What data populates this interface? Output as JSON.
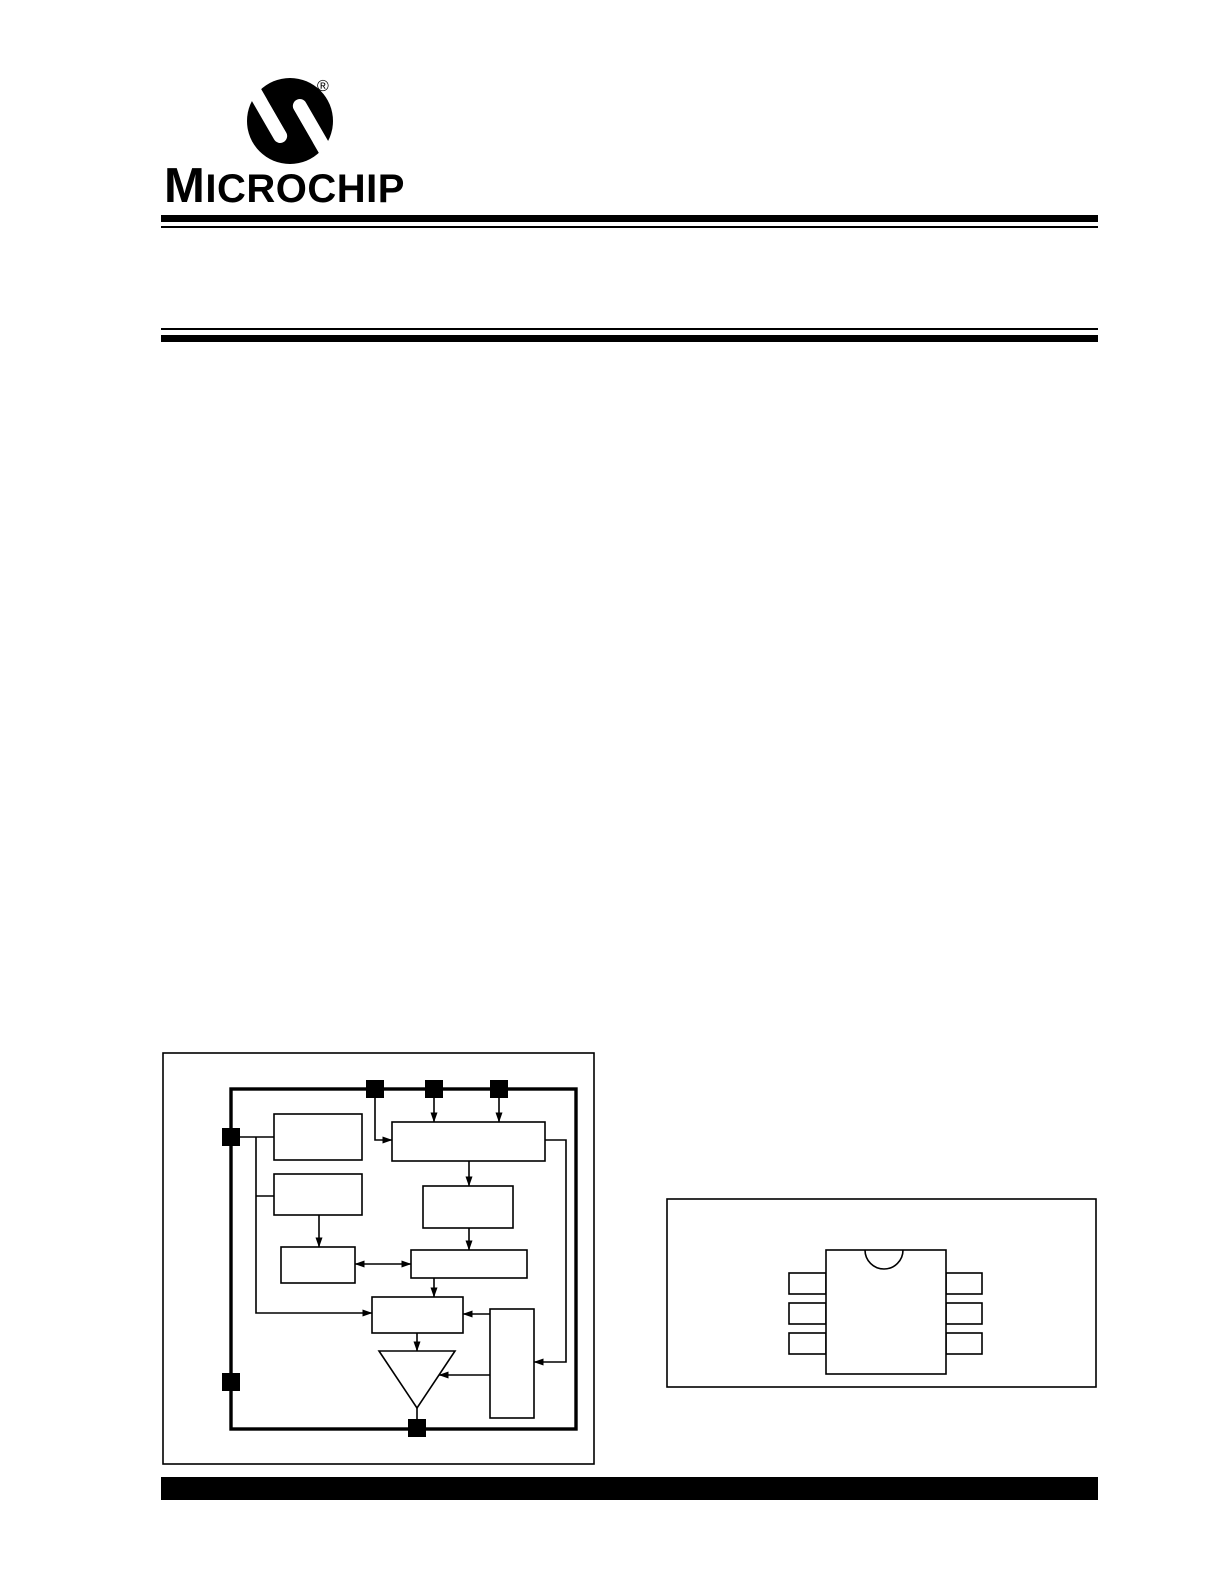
{
  "brand": {
    "wordmark_initial": "M",
    "wordmark_rest": "ICROCHIP",
    "registered_mark": "®"
  },
  "colors": {
    "ink": "#000000",
    "paper": "#ffffff"
  },
  "figures": {
    "block_diagram": {
      "frame": {
        "x": 163,
        "y": 1053,
        "w": 431,
        "h": 411
      },
      "chip_border": {
        "x": 231,
        "y": 1089,
        "w": 345,
        "h": 340
      },
      "boxes": [
        {
          "name": "block-top-left",
          "x": 274,
          "y": 1114,
          "w": 88,
          "h": 46
        },
        {
          "name": "block-mid-left",
          "x": 274,
          "y": 1174,
          "w": 88,
          "h": 41
        },
        {
          "name": "block-small-left",
          "x": 281,
          "y": 1247,
          "w": 74,
          "h": 36
        },
        {
          "name": "block-wide-top",
          "x": 392,
          "y": 1122,
          "w": 153,
          "h": 39
        },
        {
          "name": "block-mid-right",
          "x": 423,
          "y": 1186,
          "w": 90,
          "h": 42
        },
        {
          "name": "block-wide-middle",
          "x": 411,
          "y": 1250,
          "w": 116,
          "h": 28
        },
        {
          "name": "block-center-lower",
          "x": 372,
          "y": 1297,
          "w": 91,
          "h": 36
        },
        {
          "name": "block-tall-right",
          "x": 490,
          "y": 1309,
          "w": 44,
          "h": 109
        }
      ],
      "triangle": {
        "name": "triangle-buffer",
        "points": "379,1351 455,1351 417,1408"
      },
      "connectors": [
        {
          "name": "connector-line",
          "arrows": "end",
          "points": [
            [
              375,
              1098
            ],
            [
              375,
              1140
            ],
            [
              392,
              1140
            ]
          ]
        },
        {
          "name": "connector-line",
          "arrows": "end",
          "points": [
            [
              434,
              1098
            ],
            [
              434,
              1122
            ]
          ]
        },
        {
          "name": "connector-line",
          "arrows": "end",
          "points": [
            [
              499,
              1098
            ],
            [
              499,
              1122
            ]
          ]
        },
        {
          "name": "connector-line",
          "arrows": "none",
          "points": [
            [
              240,
              1137
            ],
            [
              274,
              1137
            ]
          ]
        },
        {
          "name": "connector-line",
          "arrows": "end",
          "points": [
            [
              256,
              1137
            ],
            [
              256,
              1313
            ],
            [
              372,
              1313
            ]
          ]
        },
        {
          "name": "connector-line",
          "arrows": "none",
          "points": [
            [
              256,
              1196
            ],
            [
              274,
              1196
            ]
          ]
        },
        {
          "name": "connector-line",
          "arrows": "end",
          "points": [
            [
              319,
              1215
            ],
            [
              319,
              1247
            ]
          ]
        },
        {
          "name": "connector-line",
          "arrows": "both",
          "points": [
            [
              355,
              1264
            ],
            [
              411,
              1264
            ]
          ]
        },
        {
          "name": "connector-line",
          "arrows": "end",
          "points": [
            [
              469,
              1161
            ],
            [
              469,
              1186
            ]
          ]
        },
        {
          "name": "connector-line",
          "arrows": "end",
          "points": [
            [
              469,
              1228
            ],
            [
              469,
              1250
            ]
          ]
        },
        {
          "name": "connector-line",
          "arrows": "end",
          "points": [
            [
              434,
              1278
            ],
            [
              434,
              1297
            ]
          ]
        },
        {
          "name": "connector-line",
          "arrows": "end",
          "points": [
            [
              490,
              1314
            ],
            [
              463,
              1314
            ]
          ]
        },
        {
          "name": "connector-line",
          "arrows": "end",
          "points": [
            [
              417,
              1333
            ],
            [
              417,
              1351
            ]
          ]
        },
        {
          "name": "connector-line",
          "arrows": "end",
          "points": [
            [
              490,
              1375
            ],
            [
              439,
              1375
            ]
          ]
        },
        {
          "name": "connector-line",
          "arrows": "end",
          "points": [
            [
              545,
              1140
            ],
            [
              566,
              1140
            ],
            [
              566,
              1362
            ],
            [
              534,
              1362
            ]
          ]
        },
        {
          "name": "connector-line",
          "arrows": "none",
          "points": [
            [
              417,
              1408
            ],
            [
              417,
              1420
            ]
          ]
        }
      ],
      "pads": [
        {
          "name": "pin-pad-top-1",
          "x": 366,
          "y": 1080,
          "w": 18,
          "h": 18
        },
        {
          "name": "pin-pad-top-2",
          "x": 425,
          "y": 1080,
          "w": 18,
          "h": 18
        },
        {
          "name": "pin-pad-top-3",
          "x": 490,
          "y": 1080,
          "w": 18,
          "h": 18
        },
        {
          "name": "pin-pad-left-1",
          "x": 222,
          "y": 1128,
          "w": 18,
          "h": 18
        },
        {
          "name": "pin-pad-left-2",
          "x": 222,
          "y": 1373,
          "w": 18,
          "h": 18
        },
        {
          "name": "pin-pad-bottom",
          "x": 408,
          "y": 1419,
          "w": 18,
          "h": 18
        }
      ]
    },
    "package_outline": {
      "frame": {
        "x": 667,
        "y": 1199,
        "w": 429,
        "h": 188
      },
      "body": {
        "x": 826,
        "y": 1250,
        "w": 120,
        "h": 124
      },
      "notch": {
        "cx": 884,
        "cy": 1250,
        "r": 19
      },
      "leads_left": [
        {
          "name": "package-lead-left-1",
          "x": 789,
          "y": 1273,
          "w": 37,
          "h": 21
        },
        {
          "name": "package-lead-left-2",
          "x": 789,
          "y": 1303,
          "w": 37,
          "h": 21
        },
        {
          "name": "package-lead-left-3",
          "x": 789,
          "y": 1333,
          "w": 37,
          "h": 21
        }
      ],
      "leads_right": [
        {
          "name": "package-lead-right-1",
          "x": 946,
          "y": 1273,
          "w": 36,
          "h": 21
        },
        {
          "name": "package-lead-right-2",
          "x": 946,
          "y": 1303,
          "w": 36,
          "h": 21
        },
        {
          "name": "package-lead-right-3",
          "x": 946,
          "y": 1333,
          "w": 36,
          "h": 21
        }
      ]
    }
  }
}
